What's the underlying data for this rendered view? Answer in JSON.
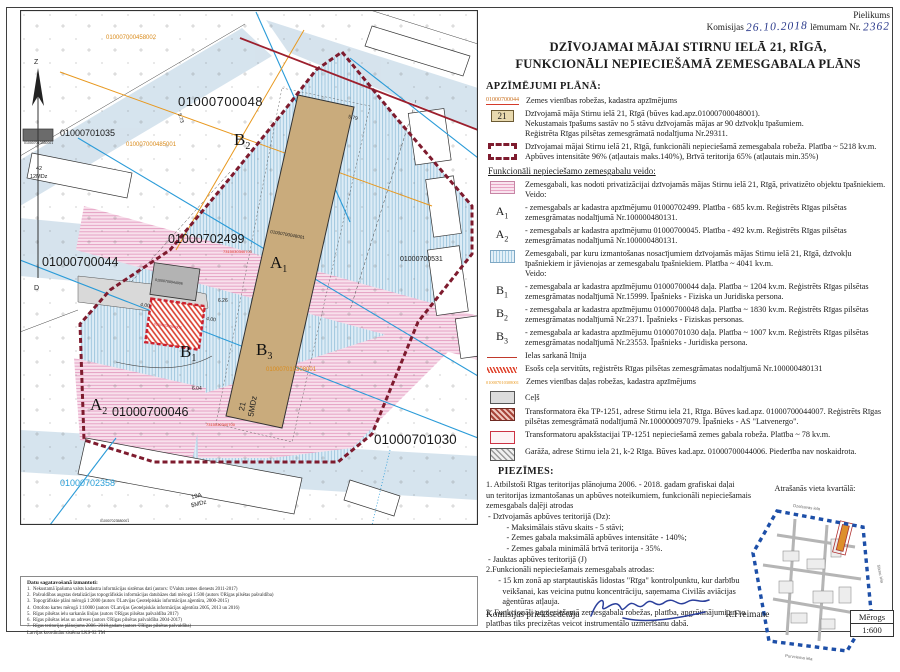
{
  "header": {
    "pielikums": "Pielikums",
    "komisijas": "Komisijas",
    "date": "26.10.2018",
    "lemumam": "lēmumam Nr.",
    "number": "2362"
  },
  "title": {
    "line1": "DZĪVOJAMAI MĀJAI STIRNU IELĀ 21, RĪGĀ,",
    "line2": "FUNKCIONĀLI NEPIECIEŠAMĀ ZEMESGABALA PLĀNS"
  },
  "legend": {
    "heading": "APZĪMĒJUMI PLĀNĀ:",
    "item_cadastre": {
      "symbol": "01000700044",
      "text": "Zemes vienības robežas, kadastra apzīmējums"
    },
    "item_house": {
      "symbol": "21",
      "lines": [
        "Dzīvojamā māja Stirnu ielā 21, Rīgā (būves kad.apz.01000700048001).",
        "Nekustamais īpašums sastāv no 5 stāvu dzīvojamās mājas ar 90 dzīvokļu īpašumiem.",
        "Reģistrēta Rīgas pilsētas zemesgrāmatā nodalījuma Nr.29311."
      ]
    },
    "item_boundary": {
      "lines": [
        "Dzīvojamai mājai Stirnu ielā 21, Rīgā, funkcionāli nepieciešamā zemesgabala robeža. Platība ~ 5218 kv.m.",
        "Apbūves intensitāte 96% (atļautais maks.140%), Brīvā teritorija 65% (atļautais min.35%)"
      ]
    },
    "subheading": "Funkcionāli nepieciešamo zemesgabalu veido:",
    "item_a": {
      "intro": "Zemesgabali, kas nodoti privatizācijai dzīvojamās mājas Stirnu ielā 21, Rīgā, privatizēto objektu īpašniekiem.",
      "veido": "Veido:",
      "a1": {
        "l": "A",
        "s": "1",
        "text": "- zemesgabals ar kadastra apzīmējumu 01000702499. Platība - 685 kv.m. Reģistrēts Rīgas pilsētas zemesgrāmatas nodalījumā Nr.100000480131."
      },
      "a2": {
        "l": "A",
        "s": "2",
        "text": "- zemesgabals ar kadastra apzīmējumu 01000700045. Platība - 492 kv.m. Reģistrēts Rīgas pilsētas zemesgrāmatas nodalījumā Nr.100000480131."
      }
    },
    "item_b": {
      "intro": "Zemesgabali, par kuru izmantošanas nosacījumiem dzīvojamās mājas Stirnu ielā 21, Rīgā, dzīvokļu īpašniekiem ir jāvienojas ar zemesgabalu īpašniekiem. Platība ~ 4041 kv.m.",
      "veido": "Veido:",
      "b1": {
        "l": "B",
        "s": "1",
        "text": "- zemesgabala ar kadastra apzīmējumu 01000700044 daļa. Platība ~ 1204 kv.m. Reģistrēts Rīgas pilsētas zemesgrāmatas nodalījumā Nr.15999. Īpašnieks - Fiziska un Juridiska persona."
      },
      "b2": {
        "l": "B",
        "s": "2",
        "text": "- zemesgabala ar kadastra apzīmējumu 01000700048 daļa. Platība ~ 1830 kv.m. Reģistrēts Rīgas pilsētas zemesgrāmatas nodalījumā Nr.2371. Īpašnieks - Fiziskas personas."
      },
      "b3": {
        "l": "B",
        "s": "3",
        "text": "- zemesgabala ar kadastra apzīmējumu 01000701030 daļa. Platība ~ 1007 kv.m. Reģistrēts Rīgas pilsētas zemesgrāmatas nodalījumā Nr.23553. Īpašnieks - Juridiska persona."
      }
    },
    "item_redline": "Ielas sarkanā līnija",
    "item_servitude": "Esošs ceļa servitūts, reģistrēts Rīgas pilsētas zemesgrāmatas nodalījumā Nr.100000480131",
    "item_partborder": {
      "symbol": "010007010308001",
      "text": "Zemes vienības daļas robežas, kadastra apzīmējums"
    },
    "item_road": "Ceļš",
    "item_transformer": "Transformatora ēka TP-1251, adrese Stirnu iela 21, Rīga. Būves kad.apz. 01000700044007. Reģistrēts Rīgas pilsētas zemesgrāmatā nodalījumā Nr.100000097079. Īpašnieks - AS \"Latvenergo\".",
    "item_substation": "Transformatoru apakšstacijai TP-1251 nepieciešamā zemes gabala robeža. Platība ~ 78 kv.m.",
    "item_garage": "Garāža, adrese Stirnu iela 21, k-2 Rīga. Būves kad.apz. 01000700044006. Piederība nav noskaidrota."
  },
  "notes": {
    "heading": "PIEZĪMES:",
    "lines": [
      "1. Atbilstoši Rīgas teritorijas plānojuma 2006. - 2018. gadam grafiskai daļai",
      "un teritorijas izmantošanas un apbūves noteikumiem, funkcionāli nepieciešamais",
      "zemesgabals daļēji atrodas",
      " - Dzīvojamās apbūves teritorijā (Dz):",
      "          - Maksimālais stāvu skaits - 5 stāvi;",
      "          - Zemes gabala maksimālā apbūves intensitāte - 140%;",
      "          - Zemes gabala minimālā brīvā teritorija - 35%.",
      " - Jauktas apbūves teritorijā (J)",
      "2.Funkcionāli nepieciešamais zemesgabals atrodas:",
      "      - 15 km zonā ap starptautiskās lidostas \"Rīga\" kontrolpunktu, kur darbību",
      "        veikšanai, kas veicina putnu koncentrāciju, saņemama Civilās aviācijas",
      "        aģentūras atļauja.",
      "3. Funkcionāli nepieciešamā zemesgabala robežas, platība, apgrūtinājumi un to",
      "platības tiks precizētas veicot instrumentālo uzmērīšanu dabā."
    ]
  },
  "location": {
    "heading": "Atrašanās vieta kvartālā:",
    "street_top": "Dzelzavas iela",
    "street_right": "Stirnu iela",
    "street_bottom": "Purvciema iela"
  },
  "signature": {
    "role": "Komisijas priekšsēdētāja",
    "name": "R.Freimane"
  },
  "scale": {
    "label": "Mērogs",
    "value": "1:600"
  },
  "sources": {
    "heading": "Datu sagatavošanā izmantoti:",
    "lines": [
      "1.  Nekustamā īpašuma valsts kadastra informācijas sistēmas dati (autors: ©Valsts zemes dienests 2011-2017)",
      "2.  Pašvaldības augstas detalizācijas topogrāfiskās informācijas datubāzes dati mērogā 1:500 (autors ©Rīgas pilsētas pašvaldība)",
      "3.  Topogrāfiskie plāni mērogā 1:2000 (autors ©Latvijas Ģeotelpiskās informācijas aģentūra, 2000-2015)",
      "4.  Ortofoto kartes mērogā 1:10000 (autors ©Latvijas Ģeotelpiskās informācijas aģentūra 2005, 2013 un 2016)",
      "5.  Rīgas pilsētas ielu sarkanās līnijas (autors ©Rīgas pilsētas pašvaldība 2017)",
      "6.  Rīgas pilsētas ielas un adreses (autors ©Rīgas pilsētas pašvaldība 2004-2017)",
      "7.  Rīgas teritorijas plānojums 2006.-2018.gadam (autors ©Rīgas pilsētas pašvaldība)",
      "Latvijas koordinātu sistēma LKS-92 TM"
    ]
  },
  "map": {
    "compass_n": "Z",
    "compass_s": "D",
    "labels": {
      "parcel48": "01000700048",
      "parcel2499": "01000702499",
      "parcel44": "01000700044",
      "parcel46": "01000700046",
      "parcel1030": "01000701030",
      "parcel1035": "01000701035",
      "parcel1035_part": "010007010350001",
      "parcel2358": "01000702358",
      "parcel2358_part": "010007023580001",
      "parcel531": "01000700531",
      "bld458002": "010007000458002",
      "bld485001": "010007000485001",
      "part1030": "010007010308001",
      "bld48001": "01000700048001",
      "tp_label": "01000700044007",
      "garage_label": "01000700044006",
      "red1": "7315030340700",
      "red2": "7315030340700",
      "house21_no": "21",
      "house21_type": "5MDz",
      "house19a_no": "19A",
      "house19a_type": "5MDz",
      "house42_no": "42",
      "house42_type": "12MDz",
      "dim579": "5.79",
      "dim573": "5.73",
      "dim626": "6.26",
      "dim604": "6.04",
      "dim400a": "4.00",
      "dim400b": "4.00"
    },
    "zones": {
      "a1": {
        "l": "A",
        "s": "1"
      },
      "a2": {
        "l": "A",
        "s": "2"
      },
      "b1": {
        "l": "B",
        "s": "1"
      },
      "b2": {
        "l": "B",
        "s": "2"
      },
      "b3": {
        "l": "B",
        "s": "3"
      }
    }
  }
}
